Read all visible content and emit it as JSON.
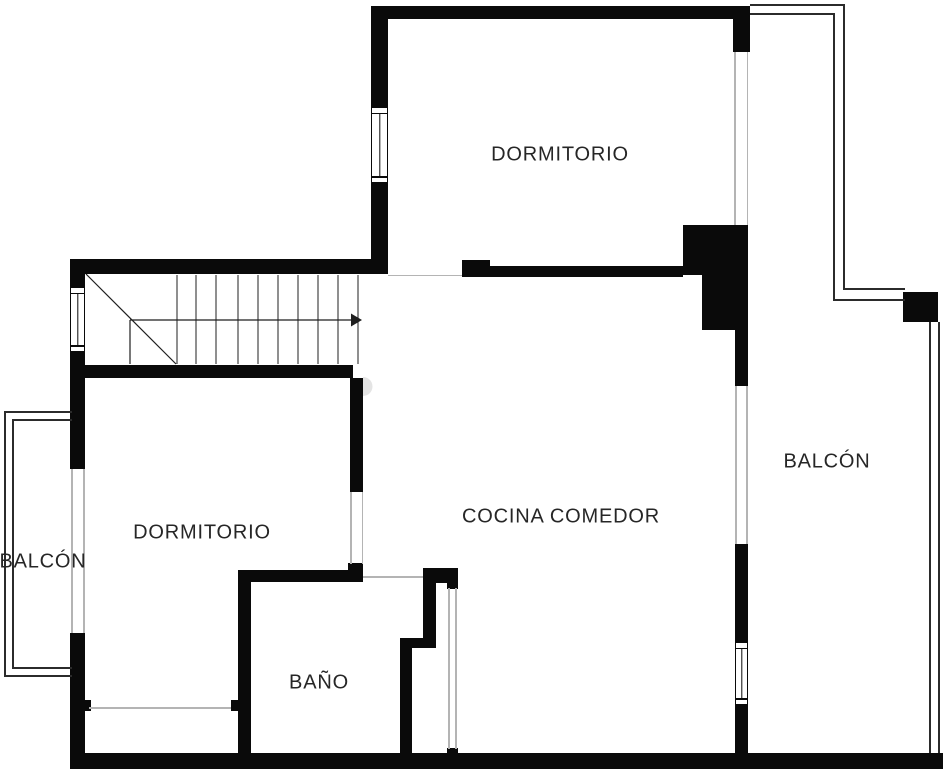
{
  "canvas": {
    "width": 946,
    "height": 774,
    "background": "#ffffff"
  },
  "colors": {
    "bg": "#ffffff",
    "wall": "#0a0a0a",
    "railing": "#2b2b2b",
    "faint_line": "#b4b4b4",
    "label_text": "#262626",
    "stair_line": "#1f1f1f",
    "door_arc_fill": "#e4e4e4"
  },
  "rooms": [
    {
      "id": "dormitorio-top",
      "label": "DORMITORIO",
      "label_x": 560,
      "label_y": 155
    },
    {
      "id": "dormitorio-left",
      "label": "DORMITORIO",
      "label_x": 202,
      "label_y": 533
    },
    {
      "id": "cocina-comedor",
      "label": "COCINA COMEDOR",
      "label_x": 561,
      "label_y": 517
    },
    {
      "id": "bano",
      "label": "BAÑO",
      "label_x": 319,
      "label_y": 683
    },
    {
      "id": "balcon-left",
      "label": "BALCÓN",
      "label_x": 43,
      "label_y": 562
    },
    {
      "id": "balcon-right",
      "label": "BALCÓN",
      "label_x": 827,
      "label_y": 462
    }
  ],
  "walls": [
    {
      "name": "top-wall",
      "x": 371,
      "y": 6,
      "w": 379,
      "h": 13
    },
    {
      "name": "dorm-top-left-wall-upper",
      "x": 371,
      "y": 6,
      "w": 17,
      "h": 101
    },
    {
      "name": "dorm-top-left-wall-lower",
      "x": 371,
      "y": 183,
      "w": 17,
      "h": 91
    },
    {
      "name": "stair-top-wall",
      "x": 70,
      "y": 259,
      "w": 318,
      "h": 15
    },
    {
      "name": "left-wall-upper",
      "x": 70,
      "y": 259,
      "w": 15,
      "h": 28
    },
    {
      "name": "left-wall-mid",
      "x": 70,
      "y": 352,
      "w": 15,
      "h": 117
    },
    {
      "name": "left-wall-lower",
      "x": 70,
      "y": 633,
      "w": 15,
      "h": 136
    },
    {
      "name": "bottom-wall",
      "x": 70,
      "y": 753,
      "w": 873,
      "h": 16
    },
    {
      "name": "stair-bottom-wall",
      "x": 70,
      "y": 365,
      "w": 283,
      "h": 13
    },
    {
      "name": "cocina-top-wall",
      "x": 462,
      "y": 266,
      "w": 221,
      "h": 11
    },
    {
      "name": "cocina-top-wall-bump",
      "x": 462,
      "y": 260,
      "w": 28,
      "h": 7
    },
    {
      "name": "top-right-stub",
      "x": 733,
      "y": 19,
      "w": 17,
      "h": 33
    },
    {
      "name": "shaft-block-a",
      "x": 683,
      "y": 225,
      "w": 65,
      "h": 50
    },
    {
      "name": "shaft-block-b",
      "x": 702,
      "y": 275,
      "w": 46,
      "h": 55
    },
    {
      "name": "shaft-block-c",
      "x": 735,
      "y": 330,
      "w": 13,
      "h": 56
    },
    {
      "name": "right-wall-mid",
      "x": 735,
      "y": 544,
      "w": 13,
      "h": 98
    },
    {
      "name": "right-wall-lower",
      "x": 735,
      "y": 705,
      "w": 13,
      "h": 48
    },
    {
      "name": "dorm2-wall-upper",
      "x": 350,
      "y": 378,
      "w": 13,
      "h": 114
    },
    {
      "name": "dorm2-wall-lower",
      "x": 348,
      "y": 563,
      "w": 15,
      "h": 19
    },
    {
      "name": "bath-top-wall",
      "x": 238,
      "y": 570,
      "w": 125,
      "h": 12
    },
    {
      "name": "bath-left-wall",
      "x": 238,
      "y": 570,
      "w": 13,
      "h": 199
    },
    {
      "name": "bath-left-jamb",
      "x": 231,
      "y": 700,
      "w": 7,
      "h": 11
    },
    {
      "name": "dorm2-left-jamb",
      "x": 85,
      "y": 700,
      "w": 6,
      "h": 11
    },
    {
      "name": "bath-right-bar",
      "x": 423,
      "y": 568,
      "w": 35,
      "h": 15
    },
    {
      "name": "bath-right-tab",
      "x": 447,
      "y": 583,
      "w": 11,
      "h": 6
    },
    {
      "name": "bath-right-wall-a",
      "x": 423,
      "y": 583,
      "w": 13,
      "h": 55
    },
    {
      "name": "bath-right-step",
      "x": 400,
      "y": 638,
      "w": 36,
      "h": 10
    },
    {
      "name": "bath-right-wall-b",
      "x": 400,
      "y": 648,
      "w": 12,
      "h": 105
    },
    {
      "name": "bath-door-jamb-bottom",
      "x": 447,
      "y": 748,
      "w": 11,
      "h": 6
    },
    {
      "name": "balcony-pillar",
      "x": 903,
      "y": 292,
      "w": 35,
      "h": 30
    }
  ],
  "railings": [
    {
      "name": "left-balcony-outer-left",
      "x": 4,
      "y": 411,
      "w": 2,
      "h": 266
    },
    {
      "name": "left-balcony-outer-top",
      "x": 4,
      "y": 411,
      "w": 68,
      "h": 2
    },
    {
      "name": "left-balcony-outer-bottom",
      "x": 4,
      "y": 675,
      "w": 68,
      "h": 2
    },
    {
      "name": "left-balcony-inner-left",
      "x": 12,
      "y": 419,
      "w": 2,
      "h": 250
    },
    {
      "name": "left-balcony-inner-top",
      "x": 12,
      "y": 419,
      "w": 60,
      "h": 2
    },
    {
      "name": "left-balcony-inner-bottom",
      "x": 12,
      "y": 667,
      "w": 60,
      "h": 2
    },
    {
      "name": "right-balcony-outer-top",
      "x": 750,
      "y": 4,
      "w": 95,
      "h": 2
    },
    {
      "name": "right-balcony-outer-right",
      "x": 843,
      "y": 4,
      "w": 2,
      "h": 286
    },
    {
      "name": "right-balcony-outer-jog",
      "x": 843,
      "y": 288,
      "w": 62,
      "h": 2
    },
    {
      "name": "right-balcony-inner-top",
      "x": 750,
      "y": 13,
      "w": 85,
      "h": 2
    },
    {
      "name": "right-balcony-inner-right",
      "x": 833,
      "y": 13,
      "w": 2,
      "h": 288
    },
    {
      "name": "right-balcony-inner-jog",
      "x": 833,
      "y": 299,
      "w": 72,
      "h": 2
    },
    {
      "name": "right-balcony-lower-inner",
      "x": 929,
      "y": 322,
      "w": 2,
      "h": 431
    },
    {
      "name": "right-balcony-lower-outer",
      "x": 938,
      "y": 322,
      "w": 2,
      "h": 431
    }
  ],
  "faint_lines": [
    {
      "name": "left-balcony-door-edge-a",
      "x": 71,
      "y": 469,
      "w": 1.5,
      "h": 164
    },
    {
      "name": "left-balcony-door-edge-b",
      "x": 83,
      "y": 469,
      "w": 1.5,
      "h": 164
    },
    {
      "name": "dorm-top-door-sill",
      "x": 388,
      "y": 274.5,
      "w": 74,
      "h": 1.5
    },
    {
      "name": "dorm-top-balcony-edge-a",
      "x": 734,
      "y": 52,
      "w": 1.5,
      "h": 173
    },
    {
      "name": "dorm-top-balcony-edge-b",
      "x": 746.5,
      "y": 52,
      "w": 1.5,
      "h": 173
    },
    {
      "name": "cocina-balcony-opening-a",
      "x": 735,
      "y": 386,
      "w": 1.5,
      "h": 158
    },
    {
      "name": "cocina-balcony-opening-b",
      "x": 746,
      "y": 386,
      "w": 1.5,
      "h": 158
    },
    {
      "name": "dorm2-door-edge-a",
      "x": 350,
      "y": 492,
      "w": 1.5,
      "h": 72
    },
    {
      "name": "dorm2-door-edge-b",
      "x": 361.5,
      "y": 492,
      "w": 1.5,
      "h": 72
    },
    {
      "name": "bath-door-sill",
      "x": 363,
      "y": 576,
      "w": 60,
      "h": 1.5
    },
    {
      "name": "bath-right-opening-a",
      "x": 448,
      "y": 588,
      "w": 1.5,
      "h": 161
    },
    {
      "name": "bath-right-opening-b",
      "x": 455,
      "y": 588,
      "w": 1.5,
      "h": 161
    },
    {
      "name": "closet-line",
      "x": 89,
      "y": 707,
      "w": 142,
      "h": 1.5
    }
  ],
  "windows": [
    {
      "name": "left-wall-window",
      "x": 70,
      "y": 287,
      "w": 15,
      "h": 65
    },
    {
      "name": "dorm-top-window",
      "x": 371,
      "y": 107,
      "w": 17,
      "h": 76
    },
    {
      "name": "right-wall-window",
      "x": 735,
      "y": 642,
      "w": 13,
      "h": 63
    }
  ],
  "stairs": {
    "treads_x": [
      177,
      196,
      216,
      238,
      258,
      278,
      298,
      318,
      338,
      358
    ],
    "tread_top_y": 275,
    "tread_bottom_y": 364,
    "lines": [
      {
        "x1": 86,
        "y1": 274,
        "x2": 176,
        "y2": 364
      },
      {
        "x1": 130,
        "y1": 320,
        "x2": 130,
        "y2": 364
      },
      {
        "x1": 130,
        "y1": 320,
        "x2": 351,
        "y2": 320
      }
    ],
    "arrow_head_points": "351,313.5 362,320 351,326.5"
  },
  "door_arc_path": "M 363 377 a 9.5 9.5 0 0 1 0 19 z"
}
